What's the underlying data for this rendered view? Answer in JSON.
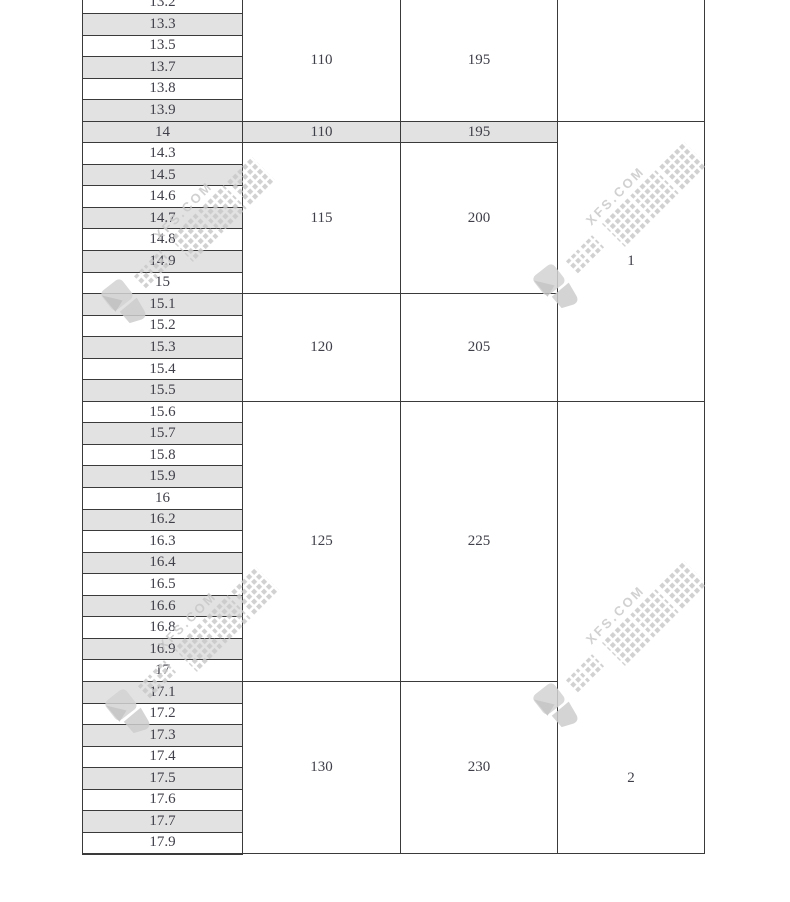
{
  "watermark": {
    "domain": "XFS.COM",
    "brand_text": "鑫方盛",
    "color": "#c9c9c9"
  },
  "table": {
    "colors": {
      "shade": "#e2e2e2",
      "border": "#3a3a3a",
      "text": "#3f3f49"
    },
    "rows": [
      {
        "label": "13.2",
        "shaded": false
      },
      {
        "label": "13.3",
        "shaded": true
      },
      {
        "label": "13.5",
        "shaded": false
      },
      {
        "label": "13.7",
        "shaded": true
      },
      {
        "label": "13.8",
        "shaded": false
      },
      {
        "label": "13.9",
        "shaded": true
      },
      {
        "label": "14",
        "shaded": true
      },
      {
        "label": "14.3",
        "shaded": false
      },
      {
        "label": "14.5",
        "shaded": true
      },
      {
        "label": "14.6",
        "shaded": false
      },
      {
        "label": "14.7",
        "shaded": true
      },
      {
        "label": "14.8",
        "shaded": false
      },
      {
        "label": "14.9",
        "shaded": true
      },
      {
        "label": "15",
        "shaded": false
      },
      {
        "label": "15.1",
        "shaded": true
      },
      {
        "label": "15.2",
        "shaded": false
      },
      {
        "label": "15.3",
        "shaded": true
      },
      {
        "label": "15.4",
        "shaded": false
      },
      {
        "label": "15.5",
        "shaded": true
      },
      {
        "label": "15.6",
        "shaded": false
      },
      {
        "label": "15.7",
        "shaded": true
      },
      {
        "label": "15.8",
        "shaded": false
      },
      {
        "label": "15.9",
        "shaded": true
      },
      {
        "label": "16",
        "shaded": false
      },
      {
        "label": "16.2",
        "shaded": true
      },
      {
        "label": "16.3",
        "shaded": false
      },
      {
        "label": "16.4",
        "shaded": true
      },
      {
        "label": "16.5",
        "shaded": false
      },
      {
        "label": "16.6",
        "shaded": true
      },
      {
        "label": "16.8",
        "shaded": false
      },
      {
        "label": "16.9",
        "shaded": true
      },
      {
        "label": "17",
        "shaded": false
      },
      {
        "label": "17.1",
        "shaded": true
      },
      {
        "label": "17.2",
        "shaded": false
      },
      {
        "label": "17.3",
        "shaded": true
      },
      {
        "label": "17.4",
        "shaded": false
      },
      {
        "label": "17.5",
        "shaded": true
      },
      {
        "label": "17.6",
        "shaded": false
      },
      {
        "label": "17.7",
        "shaded": true
      },
      {
        "label": "17.9",
        "shaded": false
      }
    ],
    "col2_cells": [
      "110",
      "110",
      "115",
      "120",
      "125",
      "130"
    ],
    "col3_cells": [
      "195",
      "195",
      "200",
      "205",
      "225",
      "230"
    ],
    "col4_cells": [
      "",
      "1",
      "2"
    ]
  }
}
